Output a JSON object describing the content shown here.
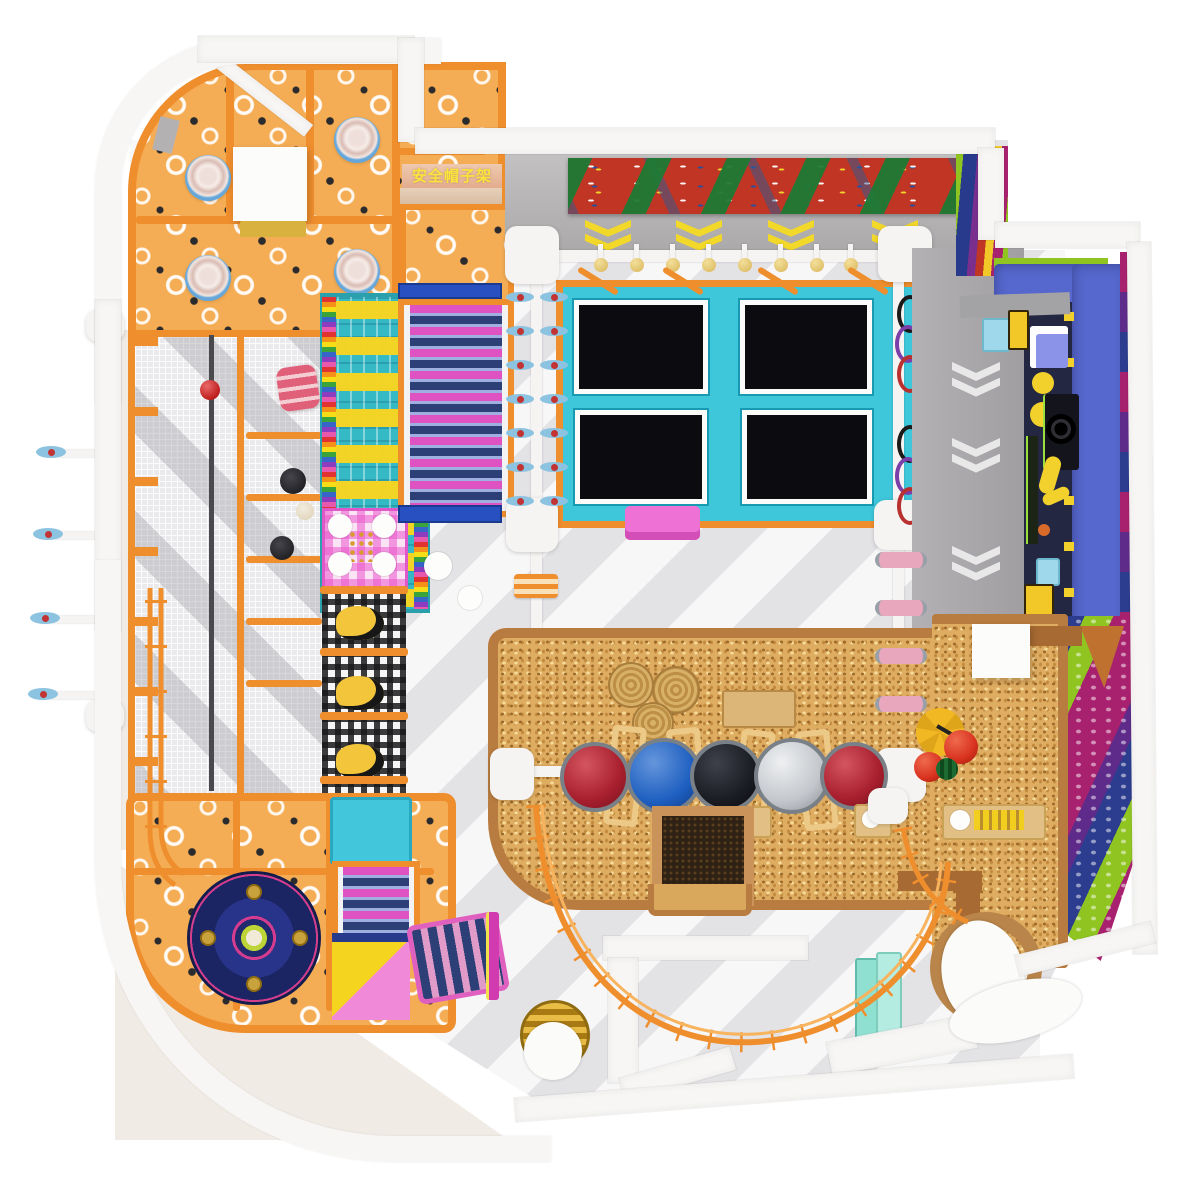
{
  "scene": {
    "type": "indoor-playground-floorplan-render",
    "view": "top-down 3D render of a children's soft-play center",
    "signs": {
      "helmet_rack": {
        "text": "安全帽子架",
        "text_color": "#f9e53b",
        "bg_color": "#e9c0a4"
      }
    },
    "zones": [
      {
        "id": "toddler-structure",
        "label": "orange toddler play structure with spinning pods"
      },
      {
        "id": "helmet-rack",
        "label": "safety helmet rack platform"
      },
      {
        "id": "mesh-cage",
        "label": "netted climbing cage with fireman pole"
      },
      {
        "id": "rainbow-climber",
        "label": "rainbow net climber"
      },
      {
        "id": "roller-slide",
        "label": "pink roller slide"
      },
      {
        "id": "gingham-mats",
        "label": "gingham crawl mats"
      },
      {
        "id": "trampoline-court",
        "label": "four-bed trampoline court"
      },
      {
        "id": "climbing-wall",
        "label": "traverse climbing wall with holds"
      },
      {
        "id": "ninja-track",
        "label": "white ninja beam track with disc swings and punch bags"
      },
      {
        "id": "arrow-corridor",
        "label": "gray corridor with chevron floor arrows"
      },
      {
        "id": "interactive-booth",
        "label": "blue interactive game booth"
      },
      {
        "id": "mural-wall",
        "label": "striped polka-dot mural wall"
      },
      {
        "id": "sand-pit",
        "label": "millet / sand pit with toys"
      },
      {
        "id": "balance-balls",
        "label": "row of giant balance balls"
      },
      {
        "id": "chocolate-pit",
        "label": "dark dig pit"
      },
      {
        "id": "spinner-zone",
        "label": "orange zone with carousel spinner disc"
      },
      {
        "id": "slide-combo",
        "label": "yellow and pink slide combo with rollers"
      },
      {
        "id": "zipline-arc",
        "label": "orange curved zipline rail"
      },
      {
        "id": "reception-podium",
        "label": "white podium benches"
      },
      {
        "id": "gold-bin",
        "label": "gold cylinder seat"
      },
      {
        "id": "mint-shelf",
        "label": "mint shelf boxes"
      },
      {
        "id": "round-platform",
        "label": "round wooden platform with white pads"
      }
    ],
    "equipment_counts": {
      "trampolines": 4,
      "spinning_pods": 4,
      "balance_balls": 5,
      "yellow_chevrons": 4,
      "white_chevrons": 4,
      "disc_swing_rows_center": 7,
      "disc_swings_left_rig": 4,
      "hanging_punch_bags": 8,
      "hanging_rings": 6,
      "pink_rollers_on_beam": 4
    },
    "balance_ball_colors": [
      "#a81f2e",
      "#1e5fc0",
      "#1b1d24",
      "#c3c6cb",
      "#a81f2e"
    ],
    "palette": {
      "frame_orange": "#ef8e2d",
      "structure_floor_orange": "#f5ad55",
      "trampoline_cyan": "#3ec6da",
      "trampoline_bed": "#0c0c10",
      "roller_pink": "#de52c2",
      "roller_navy": "#2c3f76",
      "sand_tan": "#dfad62",
      "sand_border": "#b97c40",
      "booth_blue": "#5667cd",
      "mural_navy": "#2c3c8e",
      "mural_green": "#8fc421",
      "mural_magenta": "#a8216e",
      "chevron_yellow": "#f2d829",
      "spinner_navy": "#1c2564",
      "gold": "#c9961d",
      "mint": "#8fe0d0",
      "wall_white": "#f7f6f4",
      "floor_gray": "#e3e2e5",
      "floor_light": "#f7f7f8"
    }
  }
}
